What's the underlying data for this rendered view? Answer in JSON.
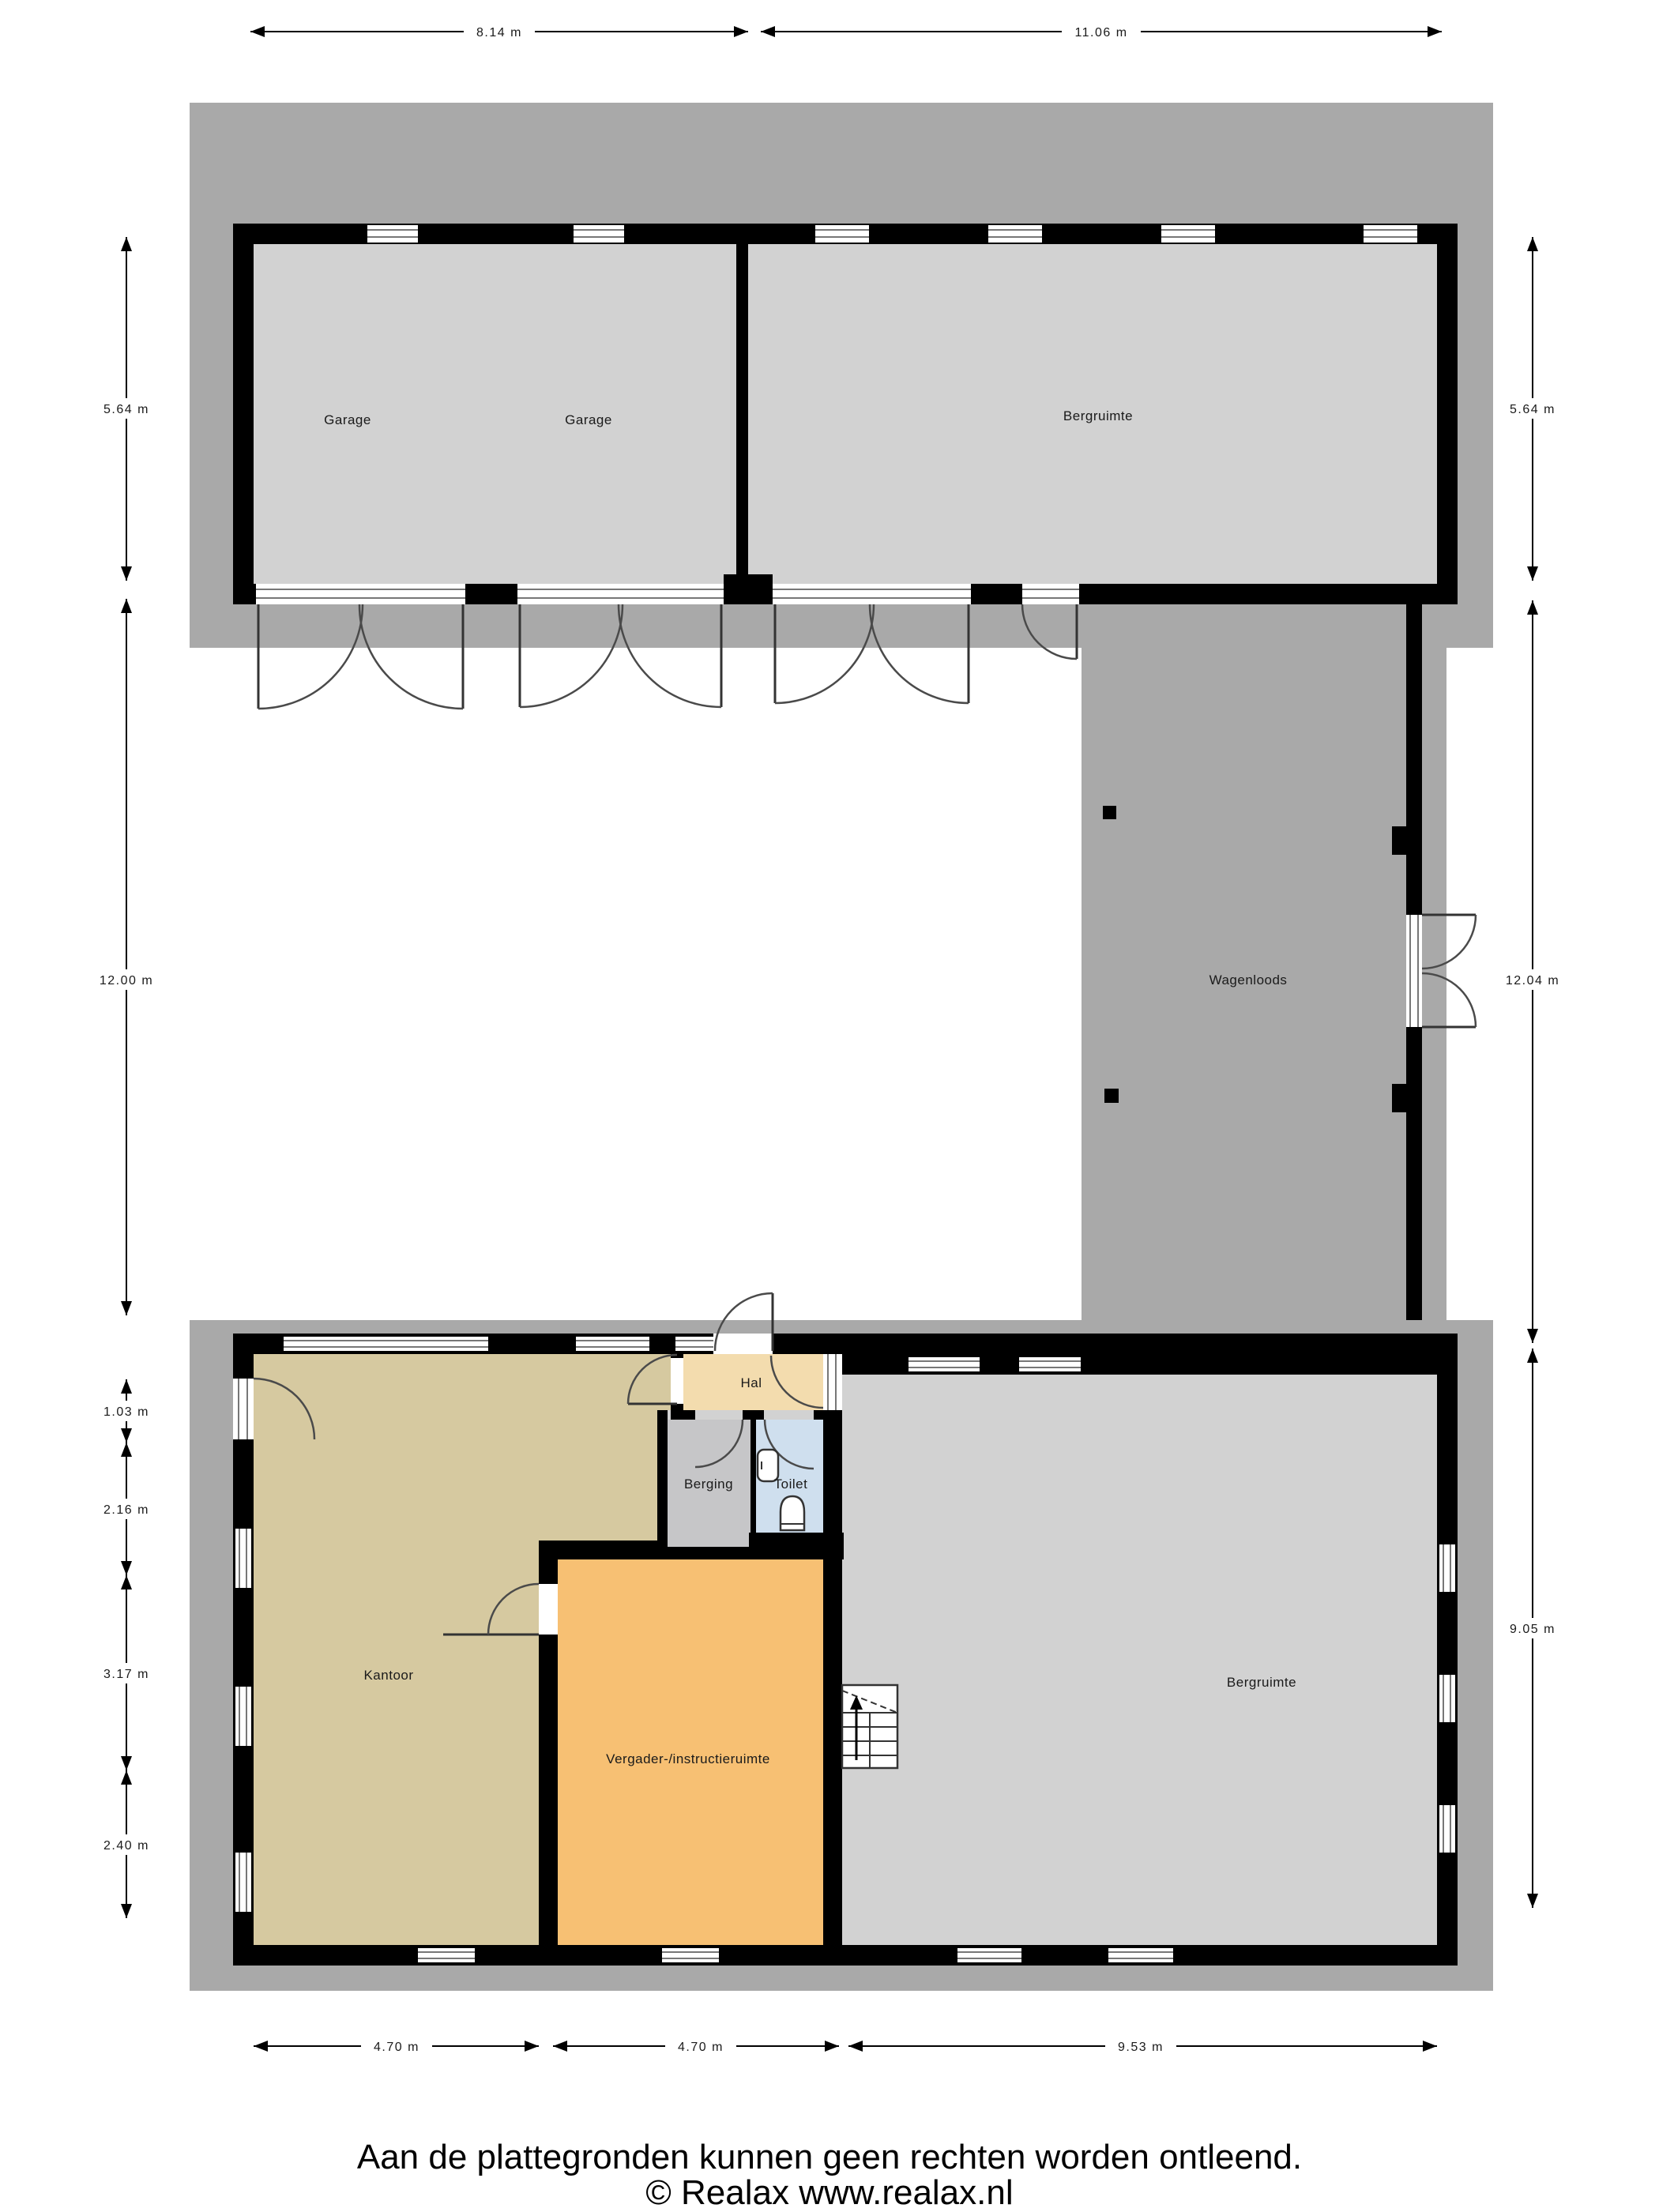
{
  "plan": {
    "rooms": {
      "garage_left": "Garage",
      "garage_right": "Garage",
      "bergruimte_top": "Bergruimte",
      "wagenloods": "Wagenloods",
      "hal": "Hal",
      "berging": "Berging",
      "toilet": "Toilet",
      "kantoor": "Kantoor",
      "vergader": "Vergader-/instructieruimte",
      "bergruimte_bottom": "Bergruimte"
    },
    "dimensions": {
      "top_1": "8.14 m",
      "top_2": "11.06 m",
      "left_1": "5.64 m",
      "left_2": "12.00 m",
      "left_3": "1.03 m",
      "left_4": "2.16 m",
      "left_5": "3.17 m",
      "left_6": "2.40 m",
      "right_1": "5.64 m",
      "right_2": "12.04 m",
      "right_3": "9.05 m",
      "bottom_1": "4.70 m",
      "bottom_2": "4.70 m",
      "bottom_3": "9.53 m"
    },
    "footer": {
      "disclaimer": "Aan de plattegronden kunnen geen rechten worden ontleend.",
      "copyright": "© Realax www.realax.nl"
    },
    "colors": {
      "outer_area": "#a9a9a9",
      "room_default": "#d2d2d2",
      "kantoor": "#d6c9a0",
      "hal": "#f3dcae",
      "vergader": "#f7c073",
      "berging": "#c6c6c8",
      "toilet": "#cfdfee",
      "wall": "#000000"
    }
  }
}
